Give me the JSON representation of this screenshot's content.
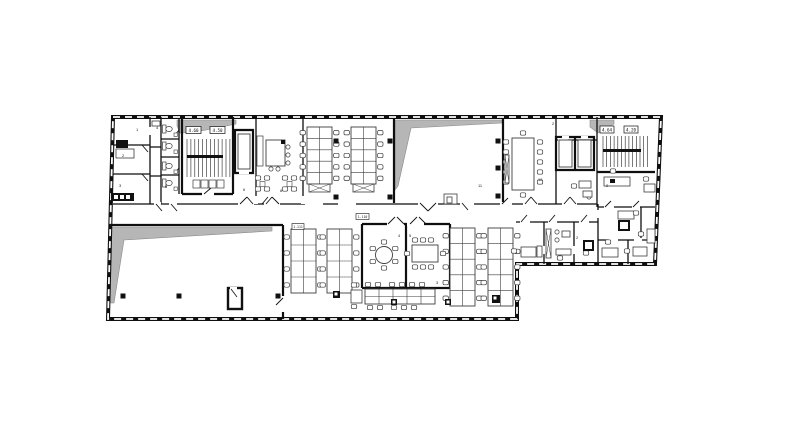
{
  "plan": {
    "chips": {
      "stair_west_a": "4.60",
      "stair_west_b": "4.50",
      "stair_east_a": "4.64",
      "stair_east_b": "4.20",
      "zone_a": "1.111",
      "zone_b": "1.110"
    },
    "room_numbers": [
      "1",
      "4",
      "2",
      "3",
      "5",
      "1",
      "6",
      "8",
      "11",
      "2",
      "12",
      "2",
      "4",
      "5",
      "3",
      "2"
    ],
    "colors": {
      "wall": "#0f0f0f",
      "shade": "#b6b6b6",
      "shade_edge": "#8a8a8a",
      "furniture": "#3d3d3d",
      "background": "#ffffff"
    }
  }
}
